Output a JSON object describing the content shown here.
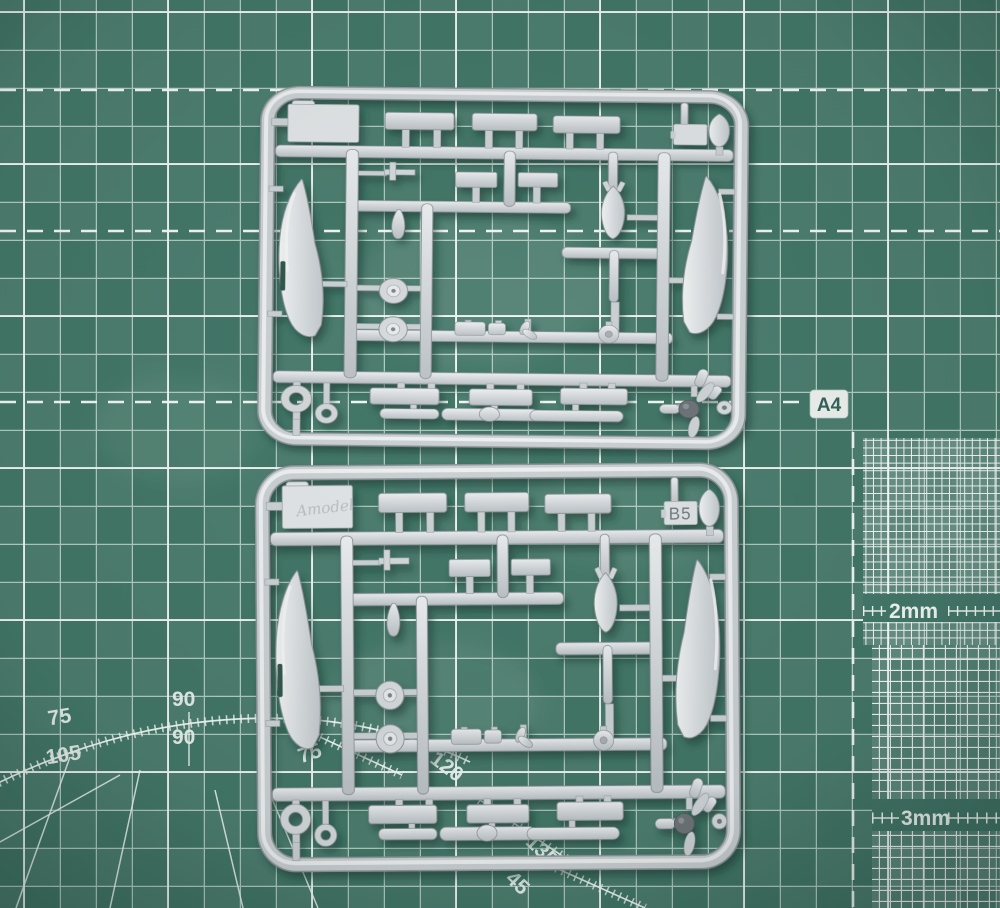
{
  "scene": {
    "description": "Photo of two light-grey injection-moulded model aircraft sprues lying on a green self-healing cutting mat",
    "colors": {
      "mat_green": "#437768",
      "mat_grid_line": "#e9f2ec",
      "plastic_light": "#e9ebec",
      "plastic_mid": "#ccd1d4",
      "plastic_shadow": "#8f969b",
      "spinner_dark": "#6e757a"
    }
  },
  "mat": {
    "size_label": "A4",
    "fine_grids": [
      {
        "label": "2mm"
      },
      {
        "label": "3mm"
      }
    ],
    "protractor": {
      "outer": [
        "75",
        "90",
        "90",
        "105"
      ],
      "inner": [
        "75",
        "120",
        "135",
        "45"
      ]
    }
  },
  "sprues": {
    "top": {
      "tag_label": "",
      "logo": ""
    },
    "bottom": {
      "tag_label": "B5",
      "logo": "Amodel"
    }
  }
}
